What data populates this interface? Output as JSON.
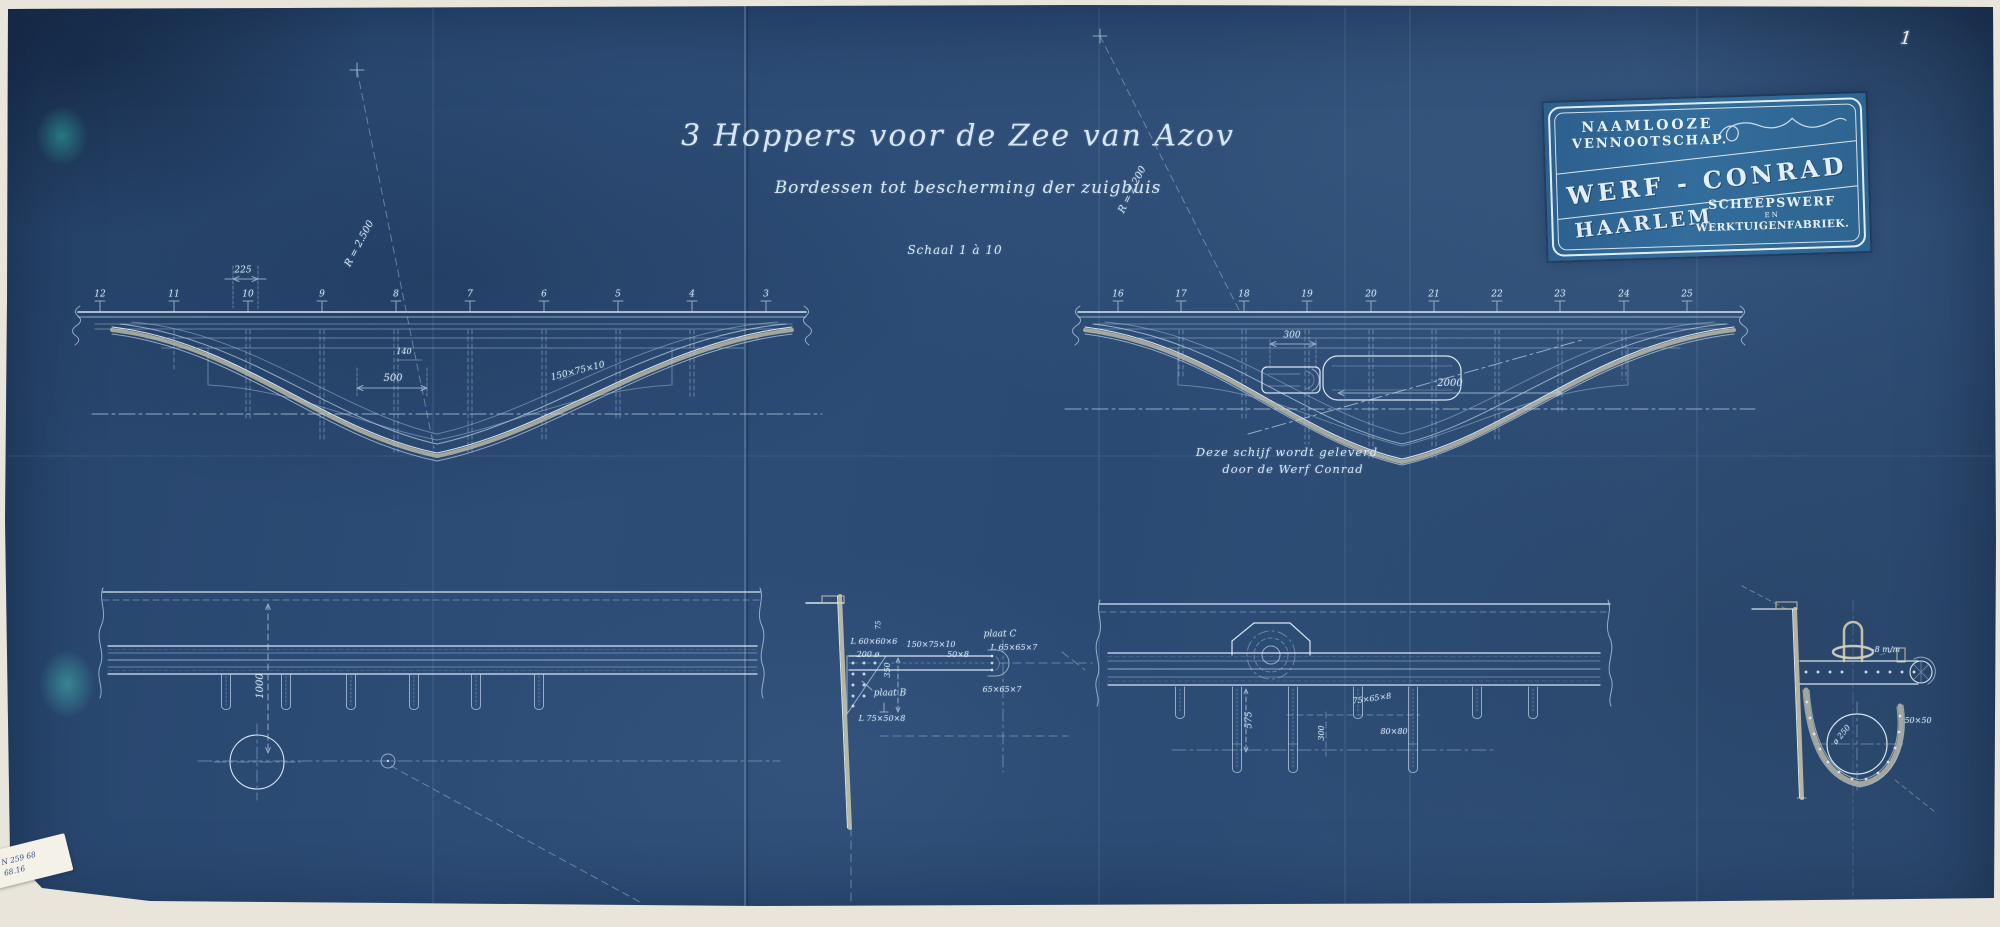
{
  "colors": {
    "sheet_blue": "#2b4a72",
    "stamp_blue": "#2f6795",
    "line_white": "#dce9f4",
    "paper_cream": "#e9e5da"
  },
  "title_block": {
    "title": "3 Hoppers voor de Zee van Azov",
    "subtitle": "Bordessen tot bescherming der zuigbuis",
    "scale_note": "Schaal 1 à 10"
  },
  "stamp": {
    "top1": "NAAMLOOZE",
    "top2": "VENNOOTSCHAP.",
    "company": "WERF - CONRAD",
    "sub1": "SCHEEPSWERF",
    "sub2": "EN",
    "sub3": "WERKTUIGENFABRIEK.",
    "city": "HAARLEM"
  },
  "handwritten_note": {
    "line1": "Deze schijf wordt geleverd",
    "line2": "door de Werf Conrad"
  },
  "page_mark": "1",
  "sticker": {
    "line1": "N 259 68",
    "line2": "68.16"
  },
  "labels": [
    {
      "t": "12",
      "x": 100,
      "y": 295,
      "s": 9,
      "n": "frame-number"
    },
    {
      "t": "11",
      "x": 174,
      "y": 295,
      "s": 9,
      "n": "frame-number"
    },
    {
      "t": "10",
      "x": 248,
      "y": 295,
      "s": 9,
      "n": "frame-number"
    },
    {
      "t": "9",
      "x": 322,
      "y": 295,
      "s": 9,
      "n": "frame-number"
    },
    {
      "t": "8",
      "x": 396,
      "y": 295,
      "s": 9,
      "n": "frame-number"
    },
    {
      "t": "7",
      "x": 470,
      "y": 295,
      "s": 9,
      "n": "frame-number"
    },
    {
      "t": "6",
      "x": 544,
      "y": 295,
      "s": 9,
      "n": "frame-number"
    },
    {
      "t": "5",
      "x": 618,
      "y": 295,
      "s": 9,
      "n": "frame-number"
    },
    {
      "t": "4",
      "x": 692,
      "y": 295,
      "s": 9,
      "n": "frame-number"
    },
    {
      "t": "3",
      "x": 766,
      "y": 295,
      "s": 9,
      "n": "frame-number"
    },
    {
      "t": "225",
      "x": 243,
      "y": 271,
      "s": 9,
      "n": "dim-label"
    },
    {
      "t": "R = 2.500",
      "x": 360,
      "y": 244,
      "s": 10,
      "r": -62,
      "n": "radius-label"
    },
    {
      "t": "500",
      "x": 393,
      "y": 379,
      "s": 10,
      "n": "dim-label"
    },
    {
      "t": "140",
      "x": 404,
      "y": 352,
      "s": 8,
      "n": "dim-label"
    },
    {
      "t": "150×75×10",
      "x": 578,
      "y": 372,
      "s": 9,
      "r": -14,
      "n": "profile-label"
    },
    {
      "t": "16",
      "x": 1118,
      "y": 295,
      "s": 9,
      "n": "frame-number"
    },
    {
      "t": "17",
      "x": 1181,
      "y": 295,
      "s": 9,
      "n": "frame-number"
    },
    {
      "t": "18",
      "x": 1244,
      "y": 295,
      "s": 9,
      "n": "frame-number"
    },
    {
      "t": "19",
      "x": 1307,
      "y": 295,
      "s": 9,
      "n": "frame-number"
    },
    {
      "t": "20",
      "x": 1371,
      "y": 295,
      "s": 9,
      "n": "frame-number"
    },
    {
      "t": "21",
      "x": 1434,
      "y": 295,
      "s": 9,
      "n": "frame-number"
    },
    {
      "t": "22",
      "x": 1497,
      "y": 295,
      "s": 9,
      "n": "frame-number"
    },
    {
      "t": "23",
      "x": 1560,
      "y": 295,
      "s": 9,
      "n": "frame-number"
    },
    {
      "t": "24",
      "x": 1624,
      "y": 295,
      "s": 9,
      "n": "frame-number"
    },
    {
      "t": "25",
      "x": 1687,
      "y": 295,
      "s": 9,
      "n": "frame-number"
    },
    {
      "t": "300",
      "x": 1292,
      "y": 336,
      "s": 9,
      "n": "dim-label"
    },
    {
      "t": "2000",
      "x": 1450,
      "y": 384,
      "s": 10,
      "n": "dim-label"
    },
    {
      "t": "R = 2.200",
      "x": 1133,
      "y": 190,
      "s": 10,
      "r": -64,
      "n": "radius-label"
    },
    {
      "t": "1000",
      "x": 261,
      "y": 686,
      "s": 10,
      "r": -90,
      "n": "dim-label"
    },
    {
      "t": "75",
      "x": 879,
      "y": 625,
      "s": 7,
      "r": -90,
      "n": "dim-label"
    },
    {
      "t": "L 60×60×6",
      "x": 874,
      "y": 642,
      "s": 8,
      "n": "profile-label"
    },
    {
      "t": "200 ø",
      "x": 868,
      "y": 655,
      "s": 8,
      "n": "dim-label"
    },
    {
      "t": "350",
      "x": 888,
      "y": 670,
      "s": 8,
      "r": -90,
      "n": "dim-label"
    },
    {
      "t": "plaat B",
      "x": 890,
      "y": 694,
      "s": 9,
      "n": "part-label"
    },
    {
      "t": "L 75×50×8",
      "x": 882,
      "y": 719,
      "s": 8,
      "n": "profile-label"
    },
    {
      "t": "150×75×10",
      "x": 931,
      "y": 645,
      "s": 8,
      "n": "profile-label"
    },
    {
      "t": "50×8",
      "x": 958,
      "y": 655,
      "s": 8,
      "n": "profile-label"
    },
    {
      "t": "plaat C",
      "x": 1000,
      "y": 635,
      "s": 9,
      "n": "part-label"
    },
    {
      "t": "L 65×65×7",
      "x": 1014,
      "y": 648,
      "s": 8,
      "n": "profile-label"
    },
    {
      "t": "65×65×7",
      "x": 1002,
      "y": 690,
      "s": 8,
      "n": "profile-label"
    },
    {
      "t": "575",
      "x": 1250,
      "y": 720,
      "s": 9,
      "r": -90,
      "n": "dim-label"
    },
    {
      "t": "300",
      "x": 1322,
      "y": 733,
      "s": 8,
      "r": -90,
      "n": "dim-label"
    },
    {
      "t": "75×65×8",
      "x": 1372,
      "y": 699,
      "s": 8,
      "r": -8,
      "n": "profile-label"
    },
    {
      "t": "80×80",
      "x": 1394,
      "y": 732,
      "s": 8,
      "n": "profile-label"
    },
    {
      "t": "-8 m/m",
      "x": 1886,
      "y": 650,
      "s": 8,
      "n": "dim-label"
    },
    {
      "t": "50×50",
      "x": 1918,
      "y": 721,
      "s": 8,
      "n": "profile-label"
    },
    {
      "t": "ø 250",
      "x": 1842,
      "y": 735,
      "s": 8,
      "r": -50,
      "n": "dim-label"
    }
  ]
}
